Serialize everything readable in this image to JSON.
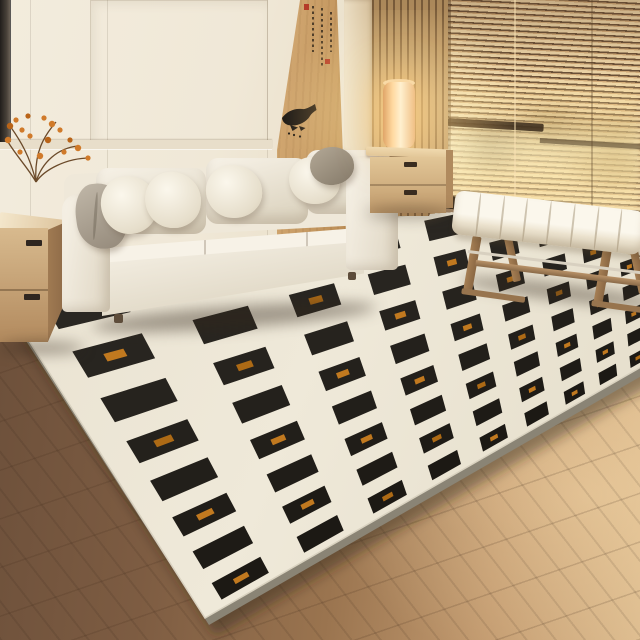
{
  "scene": {
    "subject": "Modern minimalist living room photograph with cream sofa and black-square checker rug",
    "objects": [
      "picture-frame",
      "paneled-wall",
      "wood-mural-panel",
      "ink-fish-mural",
      "calligraphy-inscription",
      "red-seal-stamps",
      "slatted-wood-screen",
      "venetian-blinds",
      "window-sill",
      "sunlit-foliage",
      "cylinder-floor-lamp",
      "two-drawer-nightstand",
      "three-seat-sofa",
      "throw-pillows",
      "gray-throw-blanket",
      "two-drawer-side-cabinet",
      "white-vase",
      "berry-branches",
      "stacked-books",
      "trinket-dish",
      "channel-tufted-bench",
      "area-rug",
      "plank-wood-floor"
    ],
    "colors": {
      "wall": "#f0e8d7",
      "wall-trim": "#e8deca",
      "wall-seam": "rgba(90,75,55,.14)",
      "frame-dark": "#211e1b",
      "panel-wood1": "#d6ad77",
      "panel-wood2": "#b98a52",
      "ink": "#221e19",
      "seal-red": "#b43a28",
      "corner1": "#ecdfc5",
      "corner2": "#d3bc97",
      "slat-line": "rgba(70,45,25,.5)",
      "blind-light": "#eed6a8",
      "blind-mid": "#d2ab79",
      "blind-dark": "#6b5138",
      "sill-dark": "#362a1d",
      "baseboard": "#efe5d0",
      "floor-dark": "#6b4f3a",
      "floor-light": "#dcbb8e",
      "sofa-light": "#f7f2e7",
      "sofa-mid": "#efe8d9",
      "sofa-dark": "#d8cfba",
      "pillow-gray1": "#c0b7a8",
      "pillow-gray2": "#94897a",
      "taupe1": "#b3a896",
      "taupe2": "#857a69",
      "cab-wood1": "#d8ba8e",
      "cab-wood2": "#b28a5e",
      "cab-side": "#a07a52",
      "night-wood1": "#e2c697",
      "night-wood2": "#c09a6b",
      "lamp-core": "#fff0cf",
      "lamp-base": "#7a5a3a",
      "bench-fab1": "#fbf7ec",
      "bench-fab2": "#ded4bd",
      "bench-wood": "#a67f54",
      "berry": "#d07a2a",
      "branch": "#6b4a2a",
      "shadow": "rgba(50,38,26,.42)"
    }
  },
  "rug": {
    "rows": 8,
    "cols": 13,
    "squareRatio": 0.55,
    "accentRatio": 0.16,
    "accentParity": 1,
    "corners": {
      "backLeft": [
        0,
        295
      ],
      "backRight": [
        740,
        150
      ],
      "frontRight": [
        740,
        310
      ],
      "frontLeft": [
        205,
        618
      ]
    },
    "gradient": [
      "#e9e2d1",
      "#efe9d9",
      "#e5decb"
    ],
    "squareBaseShade": 42,
    "accent": "#c1791f",
    "accentAlt": "#ad6a15",
    "side": "#8a8475",
    "shadow": "rgba(45,34,22,0.45)"
  },
  "bench": {
    "channels": 8
  },
  "fish": {
    "dots": [
      [
        18,
        33
      ],
      [
        24,
        34.5
      ],
      [
        13,
        31.5
      ]
    ]
  },
  "berries": [
    [
      10,
      30
    ],
    [
      16,
      24
    ],
    [
      22,
      34
    ],
    [
      8,
      44
    ],
    [
      28,
      20
    ],
    [
      44,
      22
    ],
    [
      52,
      28
    ],
    [
      60,
      34
    ],
    [
      70,
      44
    ],
    [
      78,
      52
    ],
    [
      88,
      62
    ],
    [
      30,
      40
    ],
    [
      48,
      44
    ],
    [
      64,
      56
    ],
    [
      20,
      56
    ],
    [
      40,
      60
    ]
  ]
}
